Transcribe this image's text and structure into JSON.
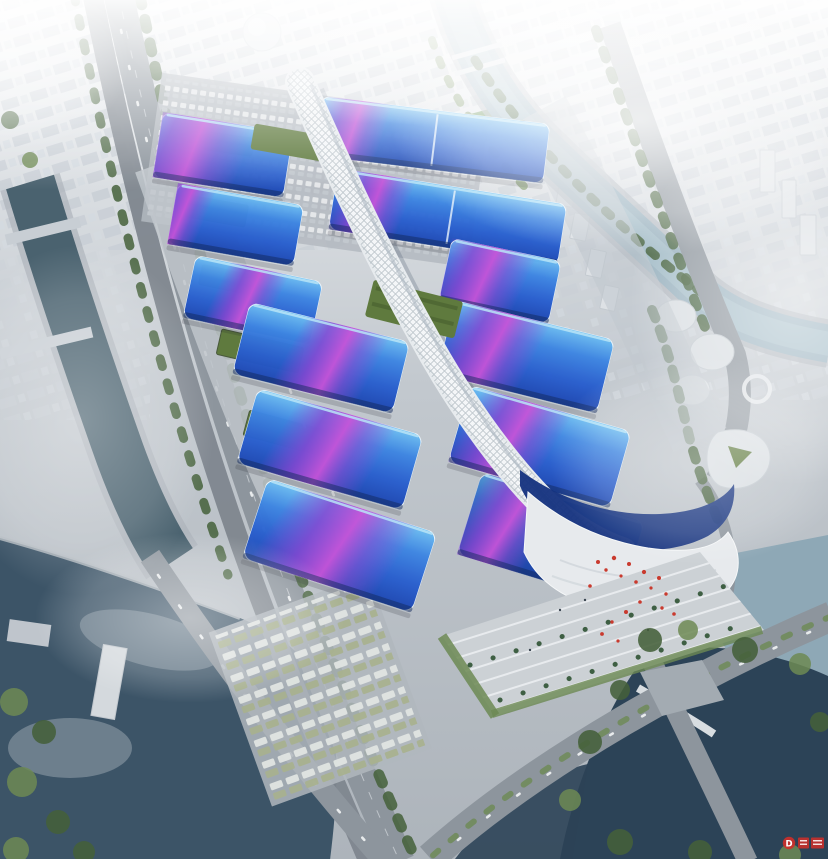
{
  "meta": {
    "title": "Aerial rendering of a large exhibition and convention center with blue and purple wave-patterned hall roofs along a white central spine corridor, surrounded by canals, rivers, roads and a hazy city skyline"
  },
  "palette": {
    "roofCyan": "#6fc0f2",
    "roofBlueMid": "#2e6fd6",
    "roofBlueDeep": "#1d46b0",
    "roofNavy": "#152f6e",
    "ribbonPurple": "#8a46d2",
    "ribbonMagenta": "#c653d8",
    "spineLight": "#eef1f3",
    "spineShade": "#aab6bf",
    "greenRoof": "#5f7a3e",
    "treeDark": "#44603a",
    "treeLight": "#6d8a54",
    "waterDark": "#3c5467",
    "waterNavy": "#2c4357",
    "waterLight": "#9bb3c0",
    "ground": "#b7bdc4",
    "road": "#8d959d",
    "roadDark": "#7e868e",
    "cityBlock": "#c9cfd6",
    "accentRed": "#cc2f2a"
  },
  "scene": {
    "complex": {
      "west_halls": 6,
      "east_halls": 6,
      "roof_style": "blue gradient roofs crossed by purple ribbon waves",
      "central_spine": "white lattice gridshell corridor running the full length of the complex",
      "green_roof_terraces": 2,
      "south_end": "wave-shaped entrance lobby with striped plaza, palm trees and red art installation"
    },
    "surroundings": {
      "north": "foggy city skyline with dome landmark and canal",
      "west": "elevated highway, canal, service yards with green-roof sheds, parking lots",
      "east": "river, tree-lined roads, cluster of rounded white buildings",
      "south": "lakes, road interchange, bus parking lots"
    }
  },
  "watermark": {
    "letter": "D",
    "color": "#cc2f2a"
  }
}
